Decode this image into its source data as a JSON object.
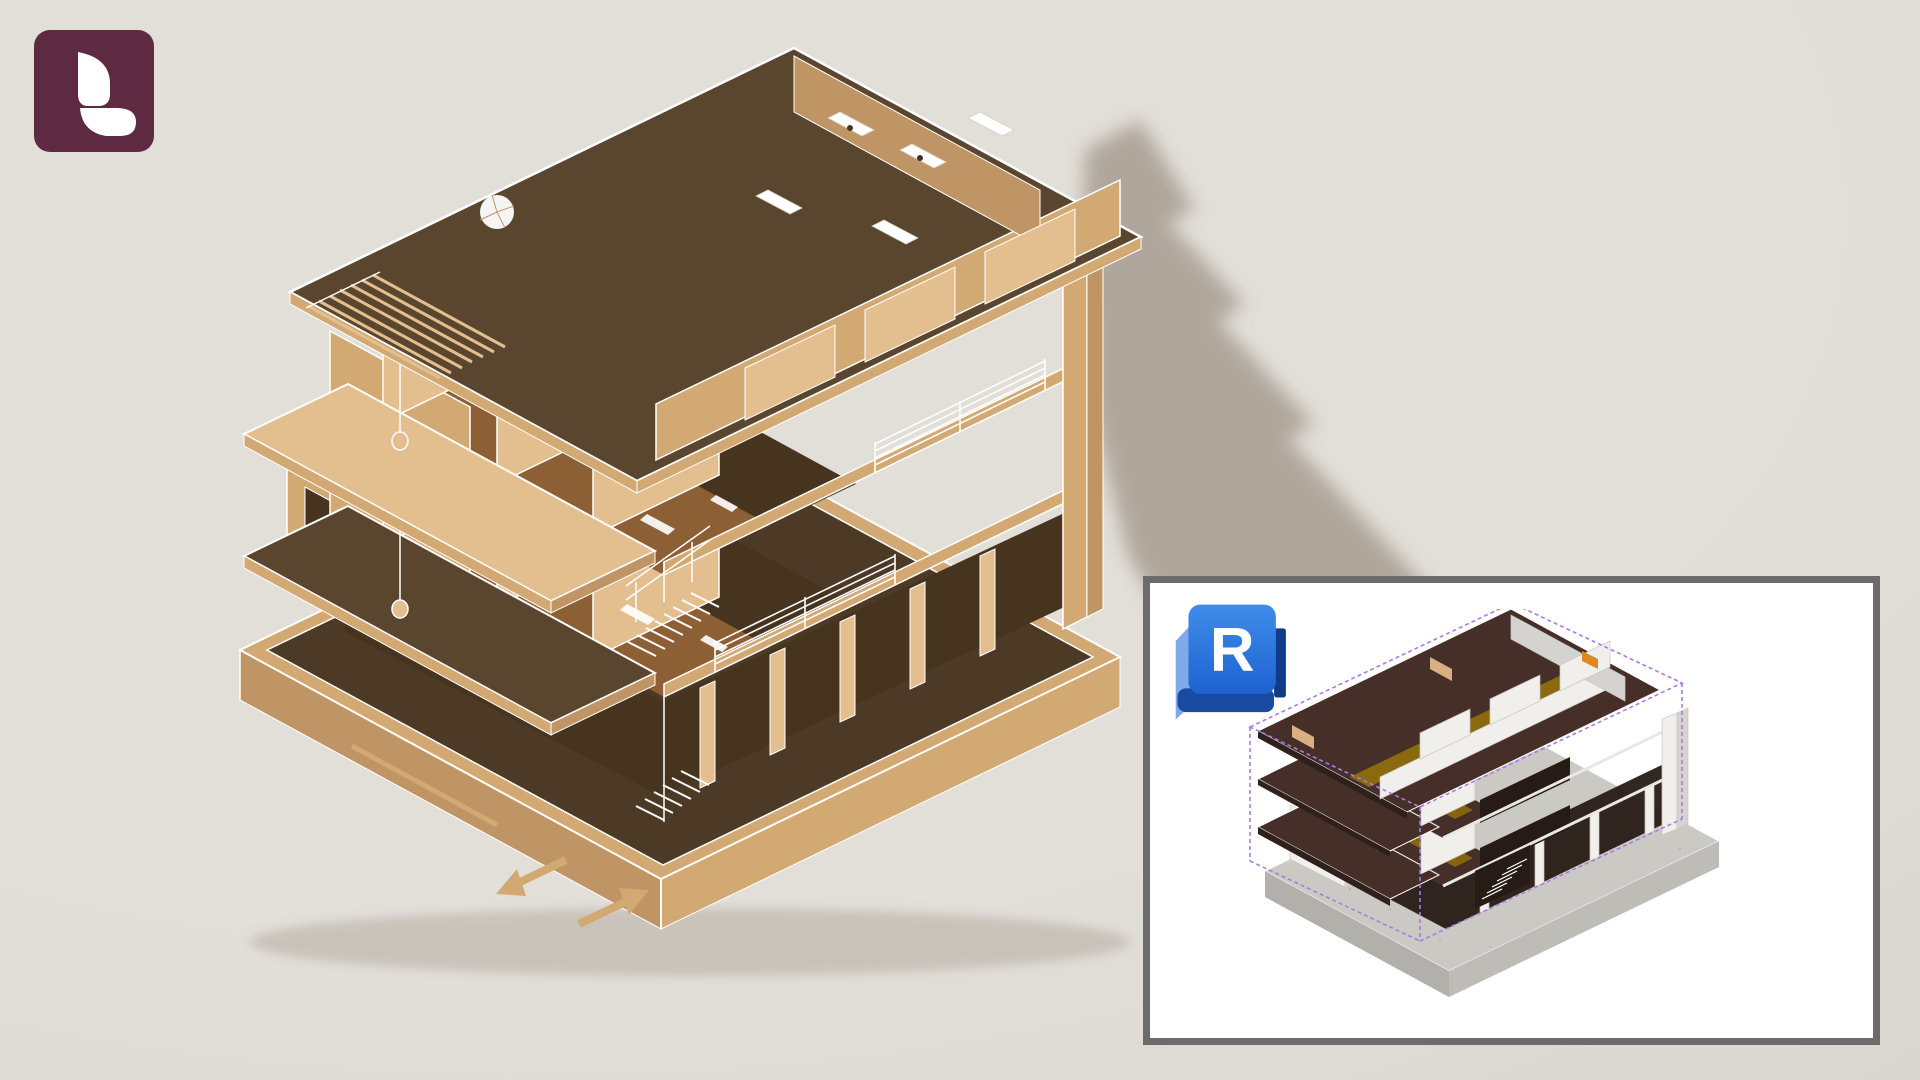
{
  "scene": {
    "kind": "architectural-cutaway-render",
    "subject": "multi-storey wooden apartment building, isometric cutaway with driveway slab and cast shadow"
  },
  "branding": {
    "app_badge": {
      "icon": "lumion-leaf-logo"
    }
  },
  "inset": {
    "badge": {
      "icon": "revit-logo",
      "letter": "R"
    },
    "preview": {
      "icon": "revit-model-isometric-preview"
    }
  },
  "colors": {
    "bg": "#e2dfd9",
    "bgEdge": "#d6d2cc",
    "shadow": "#a49a8d",
    "line": "#ffffff",
    "wood": "#d2a873",
    "woodLight": "#e3bf90",
    "woodMid": "#c09565",
    "woodDeep": "#8d5f35",
    "plate": "#5a452e",
    "plateDeep": "#46341f",
    "ground": "#4c3a26",
    "lumionBg": "#5d2a42",
    "lumionFg": "#ffffff",
    "insetBg": "#ffffff",
    "insetBorder": "#6b6b6b",
    "revitFrontA": "#3f8cea",
    "revitFrontB": "#1d63d0",
    "revitLight": "#7fa9e9",
    "revitDark": "#1a4ba3",
    "revitDarker": "#123c8a",
    "revitFg": "#ffffff",
    "rvtPlate": "#452f28",
    "rvtPlateDeep": "#2f201b",
    "rvtWall": "#f0efec",
    "rvtWallSide": "#d5d3cf",
    "rvtOchre": "#8a690f",
    "rvtBase": "#cbc9c4",
    "rvtBaseSide": "#b2b0ab",
    "rvtBaseSide2": "#bebcb7",
    "rvtTan": "#d8b083",
    "rvtOrange": "#e2871f",
    "rvtDarkOpen": "#271b16",
    "rvtPurple": "#a87ce0"
  }
}
